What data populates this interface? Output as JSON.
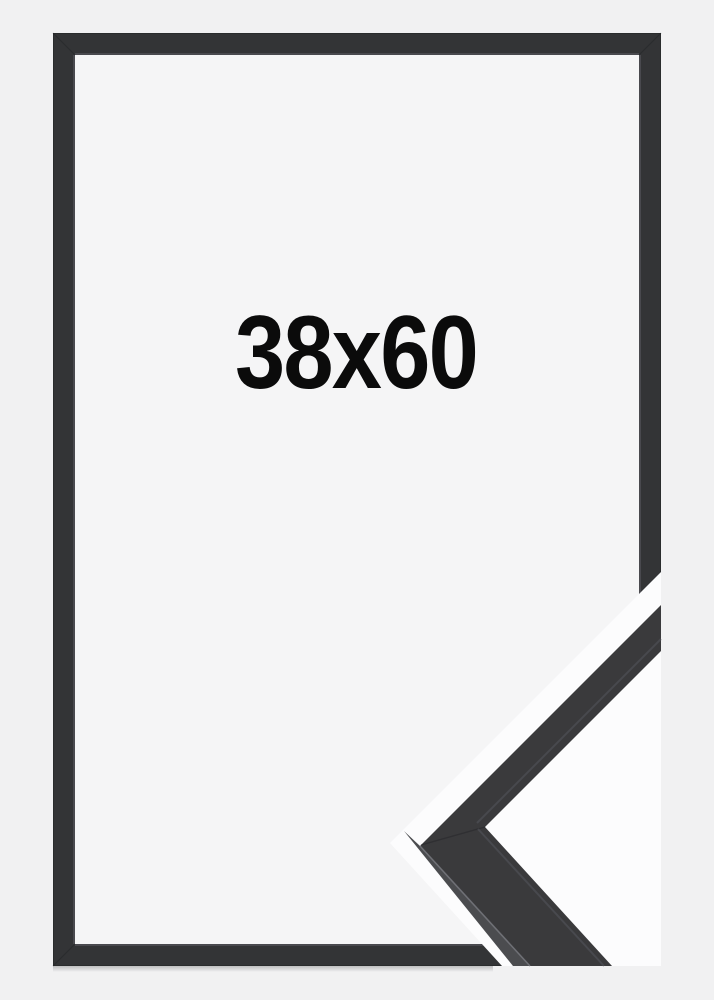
{
  "product": {
    "size_label": "38x60"
  },
  "colors": {
    "background": "#f1f1f2",
    "frame_opening": "#f5f5f6",
    "cutout_background": "#fcfcfd",
    "frame": "#333436",
    "detail_face": "#3a3a3c",
    "detail_side": "#4b4c4f",
    "label_text": "#0b0b0b"
  }
}
